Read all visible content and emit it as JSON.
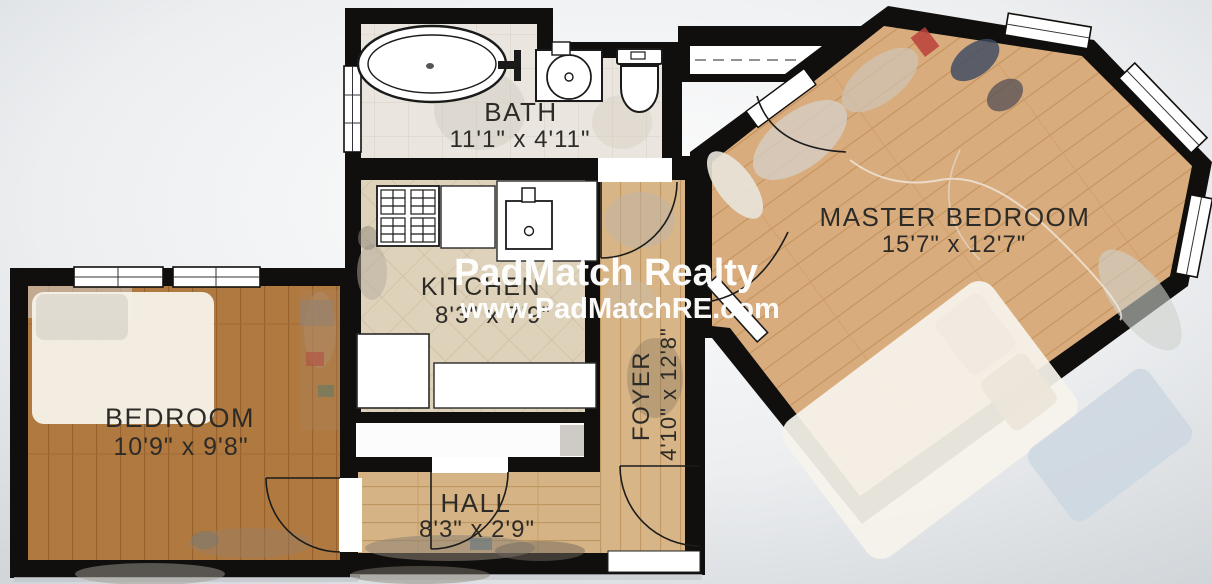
{
  "watermark": {
    "line1": "PadMatch Realty",
    "line2": "www.PadMatchRE.com"
  },
  "rooms": {
    "bath": {
      "name": "BATH",
      "dims": "11'1\" x 4'11\""
    },
    "kitchen": {
      "name": "KITCHEN",
      "dims": "8'3\" x 7'9\""
    },
    "master_bedroom": {
      "name": "MASTER BEDROOM",
      "dims": "15'7\" x 12'7\""
    },
    "bedroom": {
      "name": "BEDROOM",
      "dims": "10'9\" x 9'8\""
    },
    "foyer": {
      "name": "FOYER",
      "dims": "4'10\" x 12'8\""
    },
    "hall": {
      "name": "HALL",
      "dims": "8'3\" x 2'9\""
    }
  },
  "colors": {
    "wall": "#100f0d",
    "label": "#2d2b28",
    "watermark": "#ffffff",
    "wood_bedroom": "#b0793f",
    "wood_hall": "#d7b586",
    "wood_master": "#d9ac7d",
    "tile_kitchen": "#ded2ba",
    "tile_bath": "#eae6df"
  }
}
